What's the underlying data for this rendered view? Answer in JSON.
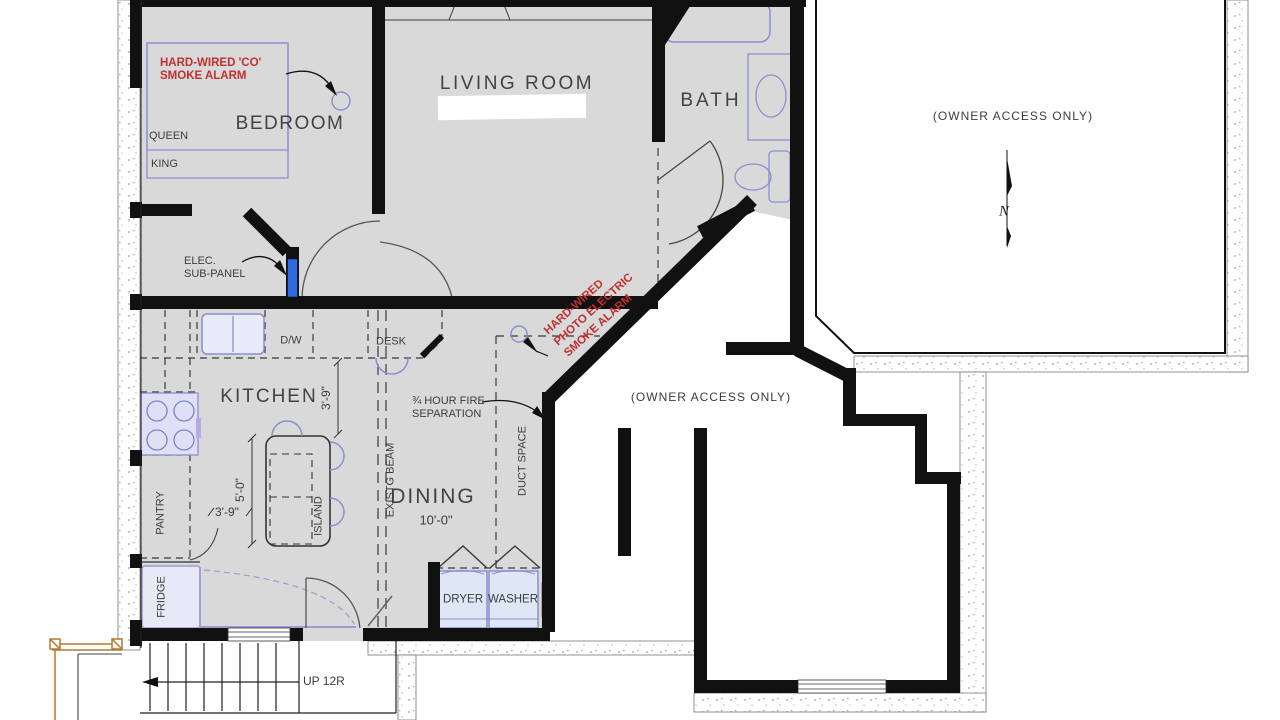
{
  "colors": {
    "floor": "#d9d9d9",
    "wall": "#111111",
    "fixture_stroke": "#8b8fd0",
    "fixture_fill": "#e7eaf7",
    "annotation_red": "#c03030",
    "text": "#3c3c3c",
    "panel_blue": "#2f6be0",
    "deck_orange": "#b5792f"
  },
  "rooms": {
    "living_room": "LIVING ROOM",
    "bedroom": "BEDROOM",
    "bath": "BATH",
    "kitchen": "KITCHEN",
    "dining": "DINING",
    "dining_width": "10'-0\"",
    "owner_access_upper": "(OWNER ACCESS ONLY)",
    "owner_access_lower": "(OWNER ACCESS ONLY)"
  },
  "fixtures": {
    "queen": "QUEEN",
    "king": "KING",
    "dishwasher": "D/W",
    "desk": "DESK",
    "pantry": "PANTRY",
    "fridge": "FRIDGE",
    "island": "ISLAND",
    "dryer": "DRYER",
    "washer": "WASHER"
  },
  "annotations": {
    "co_alarm": "HARD-WIRED 'CO'\nSMOKE ALARM",
    "photo_alarm": "HARD-WIRED\nPHOTO ELECTRIC\nSMOKE ALARM",
    "elec_panel": "ELEC.\nSUB-PANEL",
    "fire_separation": "¾ HOUR FIRE\nSEPARATION",
    "existing_beam": "EXISTG BEAM",
    "duct_space": "DUCT SPACE",
    "stairs": "UP 12R",
    "north": "N"
  },
  "dimensions": {
    "kitchen_depth": "3'-9\"",
    "island_length": "5'-0\"",
    "pantry_width": "3'-9\""
  }
}
